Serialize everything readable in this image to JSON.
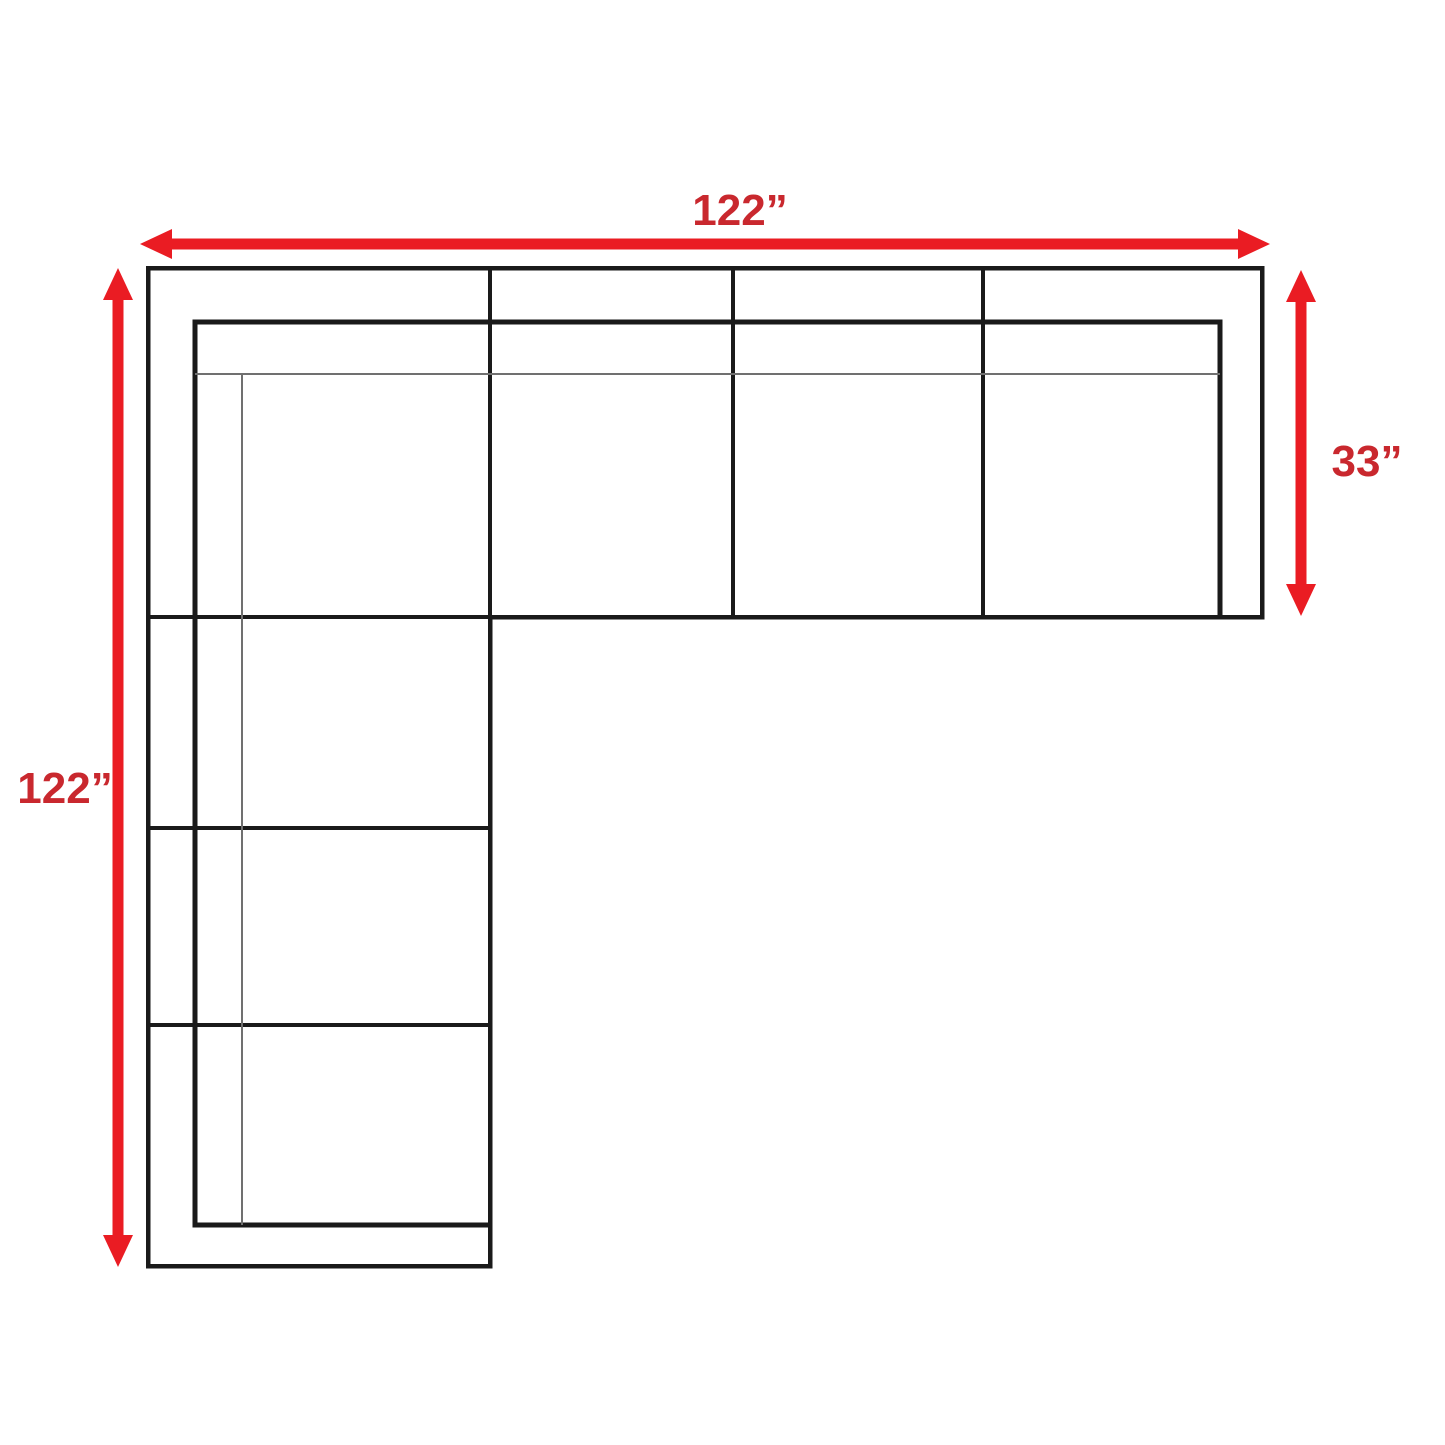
{
  "diagram": {
    "kind": "sectional-sofa-dimension-floorplan",
    "dimensions": {
      "top": "122”",
      "left": "122”",
      "right": "33”"
    },
    "colors": {
      "arrow": "#ea1c23",
      "dimension_text": "#c9282e",
      "outline": "#1a1a1a",
      "detail_line": "#707070",
      "background": "#ffffff"
    }
  }
}
